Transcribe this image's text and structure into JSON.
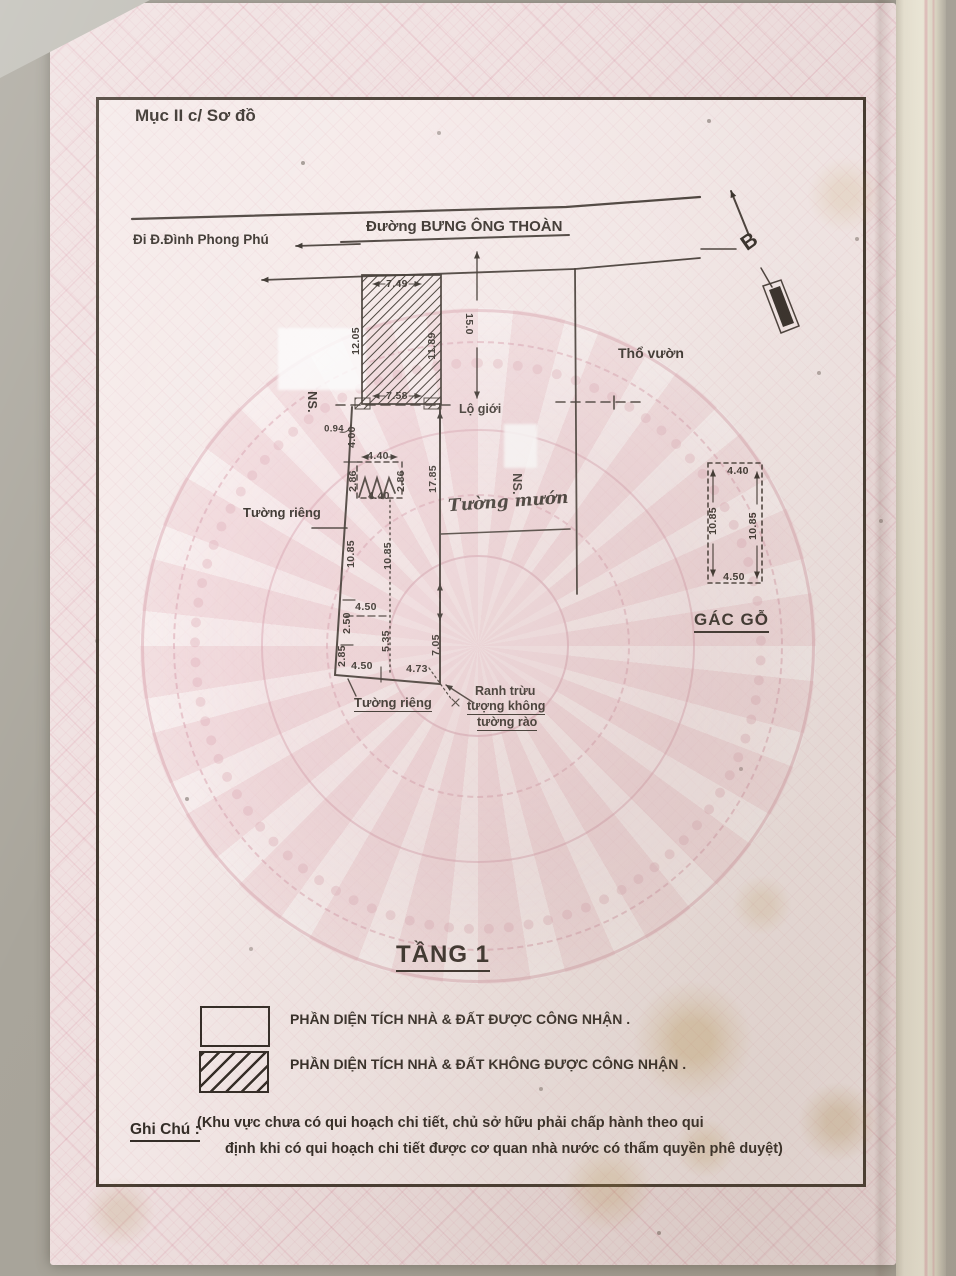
{
  "colors": {
    "ink": "#332c26",
    "pink": "#d88ba0",
    "page": "#f0e1e1",
    "frame_bg": "#f5eae9"
  },
  "doc": {
    "section_title": "Mục II c/ Sơ đồ",
    "floor_title": "TẦNG 1",
    "note_title": "Ghi Chú :",
    "note_line1": "(Khu vực chưa có qui hoạch chi tiết, chủ sở hữu phải chấp hành theo qui",
    "note_line2": "định khi có qui hoạch chi tiết được cơ quan nhà nước có thẩm quyền phê duyệt)"
  },
  "plan": {
    "street_name": "Đường BƯNG ÔNG THOÀN",
    "street_direction": "Đi Đ.Đình Phong Phú",
    "north_label": "B",
    "road_boundary_label": "Lộ giới",
    "garden_label": "Thổ vườn",
    "neighbor_label": "NS.",
    "private_wall_label": "Tường riêng",
    "borrowed_wall_label": "Tường mướn",
    "boundary_note_line1": "Ranh trừu",
    "boundary_note_line2": "tượng không",
    "boundary_note_line3": "tường rào",
    "wood_attic_label": "GÁC GỖ",
    "dims": {
      "hatched_top": "7.49",
      "hatched_left": "12.05",
      "hatched_right": "11.89",
      "hatched_bottom": "7.58",
      "road_setback": "15.0",
      "edge_offset": "0.94",
      "upper_left": "4.00",
      "stair_top": "4.40",
      "stair_left": "2.86",
      "stair_right": "2.86",
      "stair_bottom": "4.40",
      "right_upper": "17.85",
      "left_mid": "10.85",
      "center_mid": "10.85",
      "mid_width": "4.50",
      "left_lower_a": "2.50",
      "left_lower_b": "2.85",
      "center_lower": "5.35",
      "bottom_left": "4.50",
      "bottom_right": "4.73",
      "right_lower": "7.05",
      "attic_top": "4.40",
      "attic_left": "10.85",
      "attic_right": "10.85",
      "attic_bottom": "4.50"
    }
  },
  "legend": {
    "recognized": "PHẦN DIỆN TÍCH NHÀ & ĐẤT ĐƯỢC CÔNG NHẬN .",
    "not_recognized": "PHẦN DIỆN TÍCH NHÀ & ĐẤT KHÔNG ĐƯỢC CÔNG NHẬN ."
  }
}
